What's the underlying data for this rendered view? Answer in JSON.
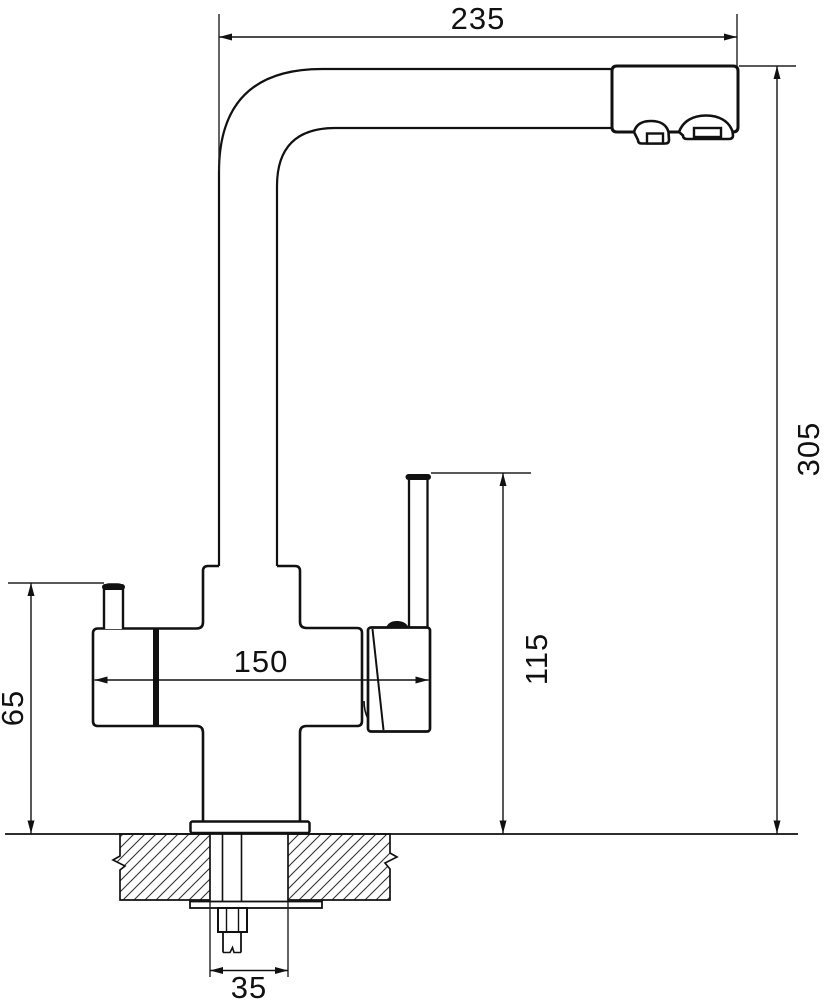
{
  "drawing": {
    "dimensions": {
      "spout_reach": "235",
      "overall_height": "305",
      "body_width": "150",
      "handle_height": "115",
      "side_outlet_height": "65",
      "mounting_hole": "35"
    },
    "colors": {
      "line": "#111111",
      "thin_line": "#222222",
      "background": "#ffffff"
    }
  }
}
